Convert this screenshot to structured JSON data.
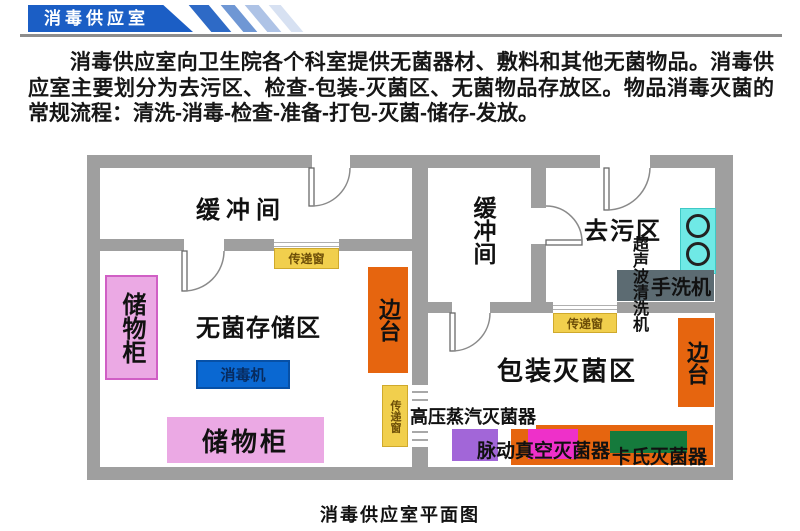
{
  "header": {
    "banner_title": "消毒供应室"
  },
  "intro": {
    "text": "消毒供应室向卫生院各个科室提供无菌器材、敷料和其他无菌物品。消毒供应室主要划分为去污区、检查-包装-灭菌区、无菌物品存放区。物品消毒灭菌的常规流程：清洗-消毒-检查-准备-打包-灭菌-储存-发放。"
  },
  "plan": {
    "rooms": {
      "buffer_room": "缓冲间",
      "sterile_storage": "无菌存储区",
      "decontamination": "去污区",
      "packing_sterilization": "包装灭菌区"
    },
    "equipment": {
      "storage_cabinet": "储物柜",
      "side_table": "边台",
      "disinfector": "消毒机",
      "pass_window": "传递窗",
      "ultrasonic_cleaner": "超声波清洗机",
      "hand_washer": "手洗机",
      "steam_sterilizer": "高压蒸汽灭菌器",
      "pulse_vacuum_sterilizer": "脉动真空灭菌器",
      "cassette_sterilizer": "卡氏灭菌器"
    },
    "palette": {
      "wall_gray": "#9f9f9f",
      "banner_blue": "#1b5ec5",
      "stripe_blues": [
        "#2e6ac6",
        "#6f97d4",
        "#aec3e6",
        "#d7e1f2"
      ],
      "pass_window_yellow": "#f1cf4d",
      "side_table_orange": "#e6650f",
      "cabinet_pink": "#eba9e4",
      "sterilizer_purple": "#a266d8",
      "sterilizer_magenta": "#ee30c9",
      "sterilizer_green": "#157a3c",
      "disinfector_blue": "#0a68d2",
      "sink_cyan": "#6fe9e6",
      "hand_washer_slate": "#5c6b72"
    }
  },
  "caption": "消毒供应室平面图"
}
